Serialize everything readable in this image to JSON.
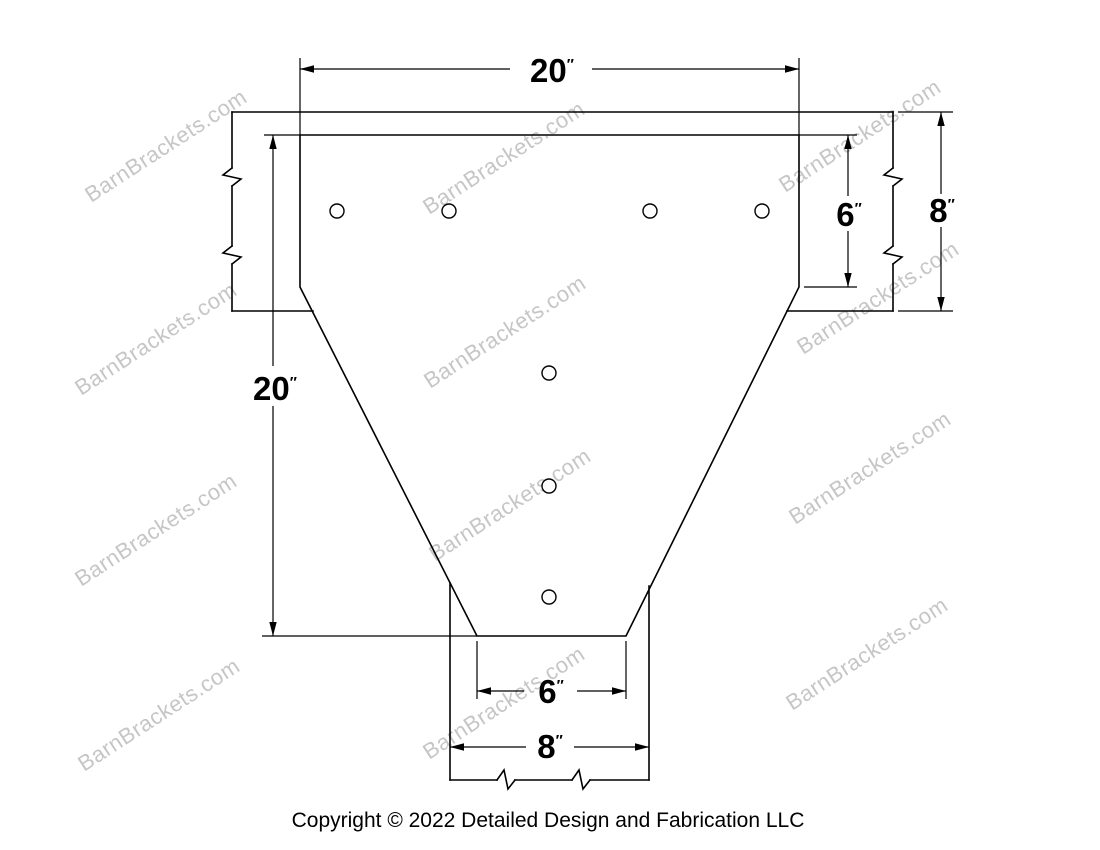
{
  "drawing": {
    "description": "T shaped barn bracket technical drawing",
    "colors": {
      "line": "#000000",
      "background": "#ffffff",
      "watermark": "#c6c6c6"
    }
  },
  "watermark": {
    "text": "BarnBrackets.com"
  },
  "copyright": {
    "text": "Copyright © 2022 Detailed Design and Fabrication LLC"
  },
  "dimensions": {
    "top_width": {
      "value": "20",
      "unit": "″"
    },
    "left_height": {
      "value": "20",
      "unit": "″"
    },
    "right_inner_height": {
      "value": "6",
      "unit": "″"
    },
    "right_outer_height": {
      "value": "8",
      "unit": "″"
    },
    "bottom_inner_width": {
      "value": "6",
      "unit": "″"
    },
    "bottom_outer_width": {
      "value": "8",
      "unit": "″"
    }
  },
  "bracket": {
    "holes": {
      "radius": 7,
      "centers": [
        {
          "x": 337,
          "y": 211
        },
        {
          "x": 449,
          "y": 211
        },
        {
          "x": 650,
          "y": 211
        },
        {
          "x": 762,
          "y": 211
        },
        {
          "x": 549,
          "y": 373
        },
        {
          "x": 549,
          "y": 486
        },
        {
          "x": 549,
          "y": 597
        }
      ]
    }
  }
}
